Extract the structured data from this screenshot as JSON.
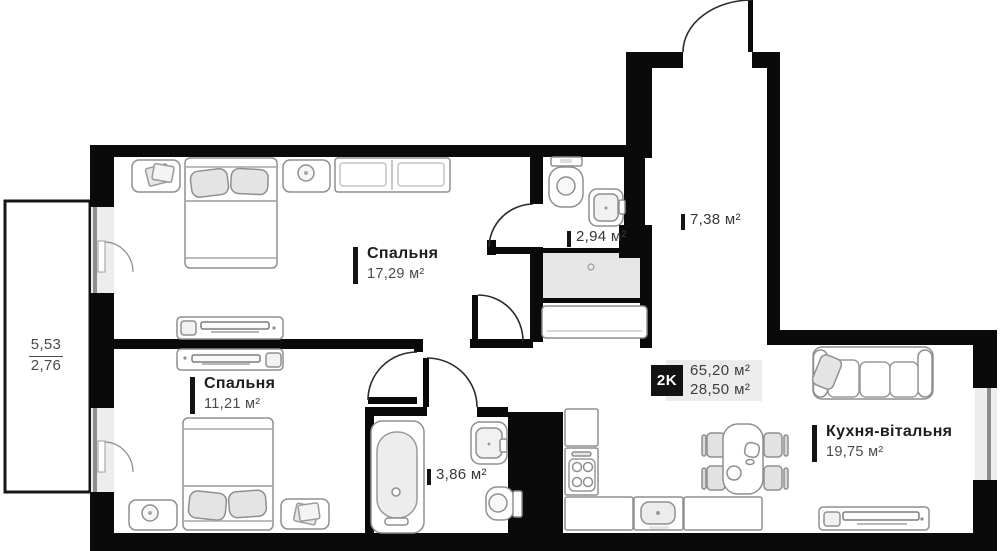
{
  "badge": {
    "label": "2K",
    "total_area": "65,20 м²",
    "living_area": "28,50 м²"
  },
  "rooms": {
    "bedroom1": {
      "name": "Спальня",
      "area": "17,29 м²"
    },
    "bedroom2": {
      "name": "Спальня",
      "area": "11,21 м²"
    },
    "bathroom_small": {
      "area": "2,94 м²"
    },
    "hallway": {
      "area": "7,38 м²"
    },
    "bathroom_large": {
      "area": "3,86 м²"
    },
    "kitchen_living": {
      "name": "Кухня-вітальня",
      "area": "19,75 м²"
    }
  },
  "balcony": {
    "dim_top": "5,53",
    "dim_bottom": "2,76"
  },
  "colors": {
    "wall": "#0a0a0a",
    "room_name_text": "#1e1e1e",
    "area_text": "#4b4b4b",
    "badge_bg": "#131313",
    "badge_panel": "#ececec",
    "shade": "#e7e7e7",
    "window": "#ededed",
    "furniture_stroke": "#8f8f8f"
  }
}
